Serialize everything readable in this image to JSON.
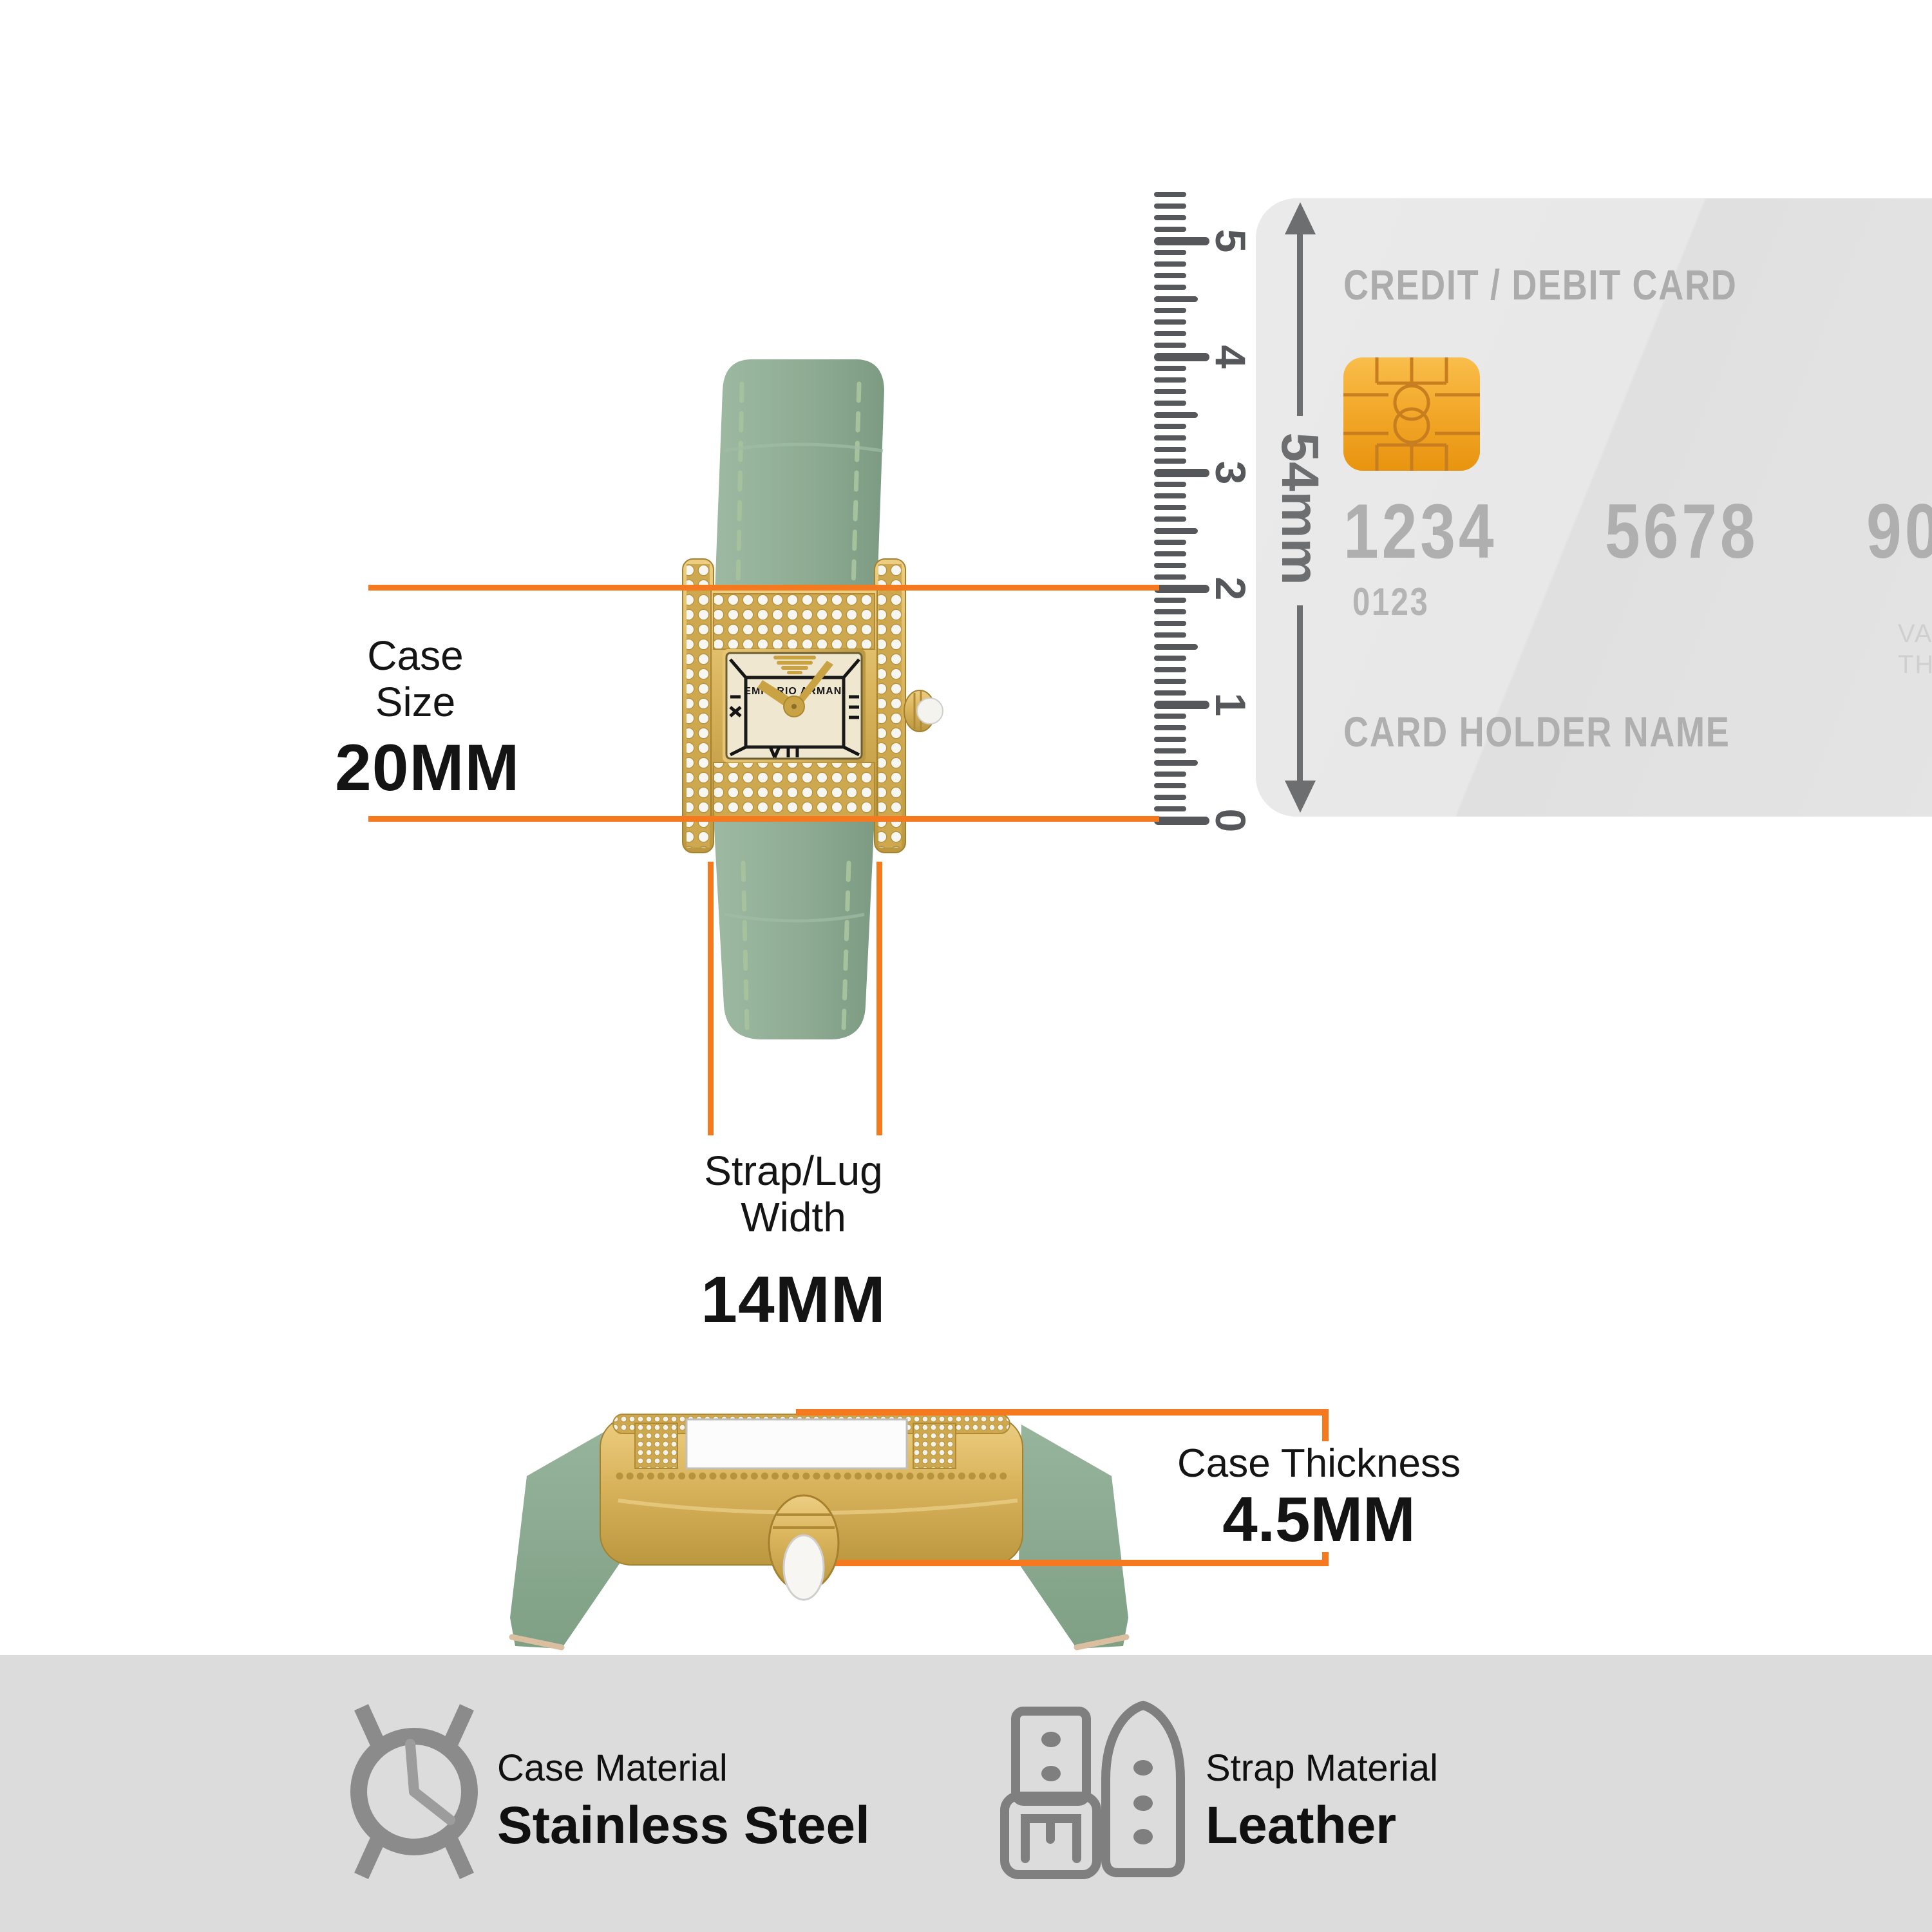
{
  "colors": {
    "accent_orange": "#F5791F",
    "ruler_gray": "#56575A",
    "arrow_gray": "#6D6E70",
    "card_bg": "#E6E6E6",
    "card_text": "#ADADAD",
    "chip_gold": "#F3A92C",
    "watch_gold": "#D9B45C",
    "strap_green": "#8FAC93",
    "dial_cream": "#EFE7CF",
    "icon_gray": "#848484",
    "band_bg": "#DCDCDC"
  },
  "case_size": {
    "label_line1": "Case",
    "label_line2": "Size",
    "value": "20MM"
  },
  "lug_width": {
    "label_line1": "Strap/Lug",
    "label_line2": "Width",
    "value": "14MM"
  },
  "case_thickness": {
    "label": "Case Thickness",
    "value": "4.5MM"
  },
  "ruler": {
    "numbers": [
      "0",
      "1",
      "2",
      "3",
      "4",
      "5"
    ],
    "mm_ticks": 54
  },
  "card": {
    "title": "CREDIT / DEBIT CARD",
    "number_groups": [
      "1234",
      "5678",
      "9098"
    ],
    "sub_number": "0123",
    "valid_line1": "VALID",
    "valid_line2": "THRU",
    "holder": "CARD HOLDER NAME",
    "height_label": "54mm"
  },
  "watch": {
    "dial_brand": "EMPORIO ARMANI"
  },
  "materials": {
    "case": {
      "label": "Case Material",
      "value": "Stainless Steel"
    },
    "strap": {
      "label": "Strap Material",
      "value": "Leather"
    }
  }
}
